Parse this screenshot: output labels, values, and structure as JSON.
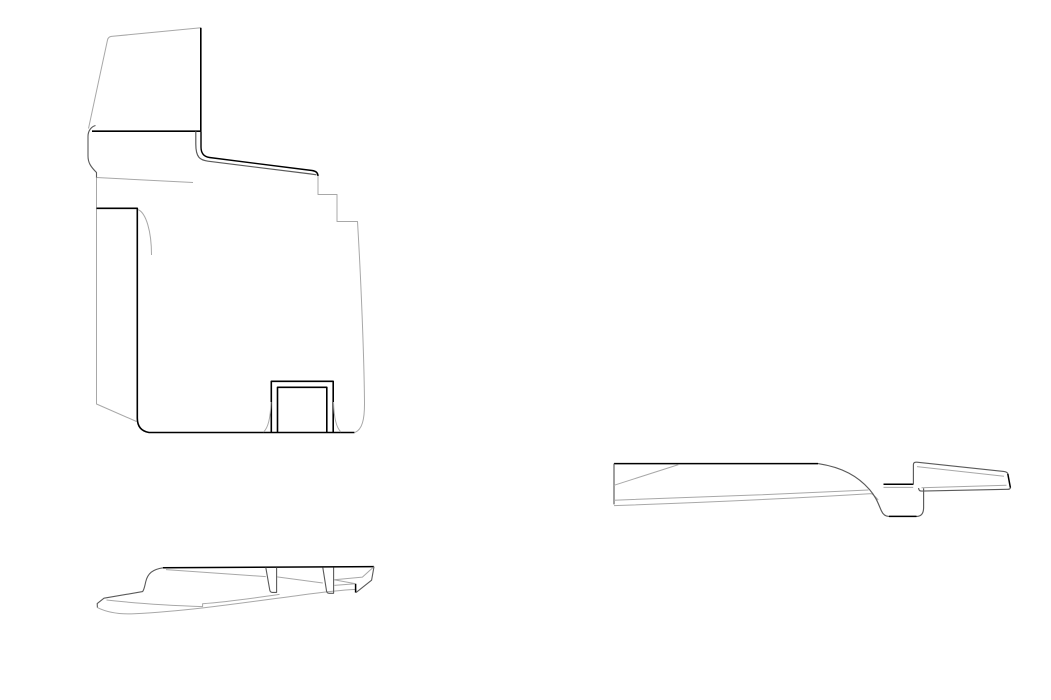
{
  "canvas": {
    "width": 1051,
    "height": 700,
    "background": "#ffffff"
  },
  "palette": {
    "bold": "#000000",
    "dark": "#5a5a5a",
    "light": "#a8a8a8"
  },
  "drawings": [
    {
      "id": "panel-side-view",
      "label": "large panel section with window flange and U-channel cutout",
      "paths": [
        {
          "c": "light",
          "w": 1,
          "d": "M88.5,128.5 C92,112 101,70 107.5,40 Q108.2,36.8 111.5,36.4 L201,27.8"
        },
        {
          "c": "bold",
          "w": 1.6,
          "d": "M200.8,27.8 L200.8,131.2"
        },
        {
          "c": "bold",
          "w": 1.6,
          "d": "M92,131.2 L201,131.2"
        },
        {
          "c": "dark",
          "w": 1.1,
          "d": "M95.5,125.5 C91.5,126.5 88,130.5 88,136.5 L88,156 C88,162.5 90.5,166.5 96.5,172.5 L96.5,178"
        },
        {
          "c": "light",
          "w": 1,
          "d": "M96.5,177.5 L193,182.5"
        },
        {
          "c": "light",
          "w": 1,
          "d": "M96.5,178 L96.5,404 L136.5,421.5"
        },
        {
          "c": "bold",
          "w": 1.6,
          "d": "M96.5,208.3 L137.3,208.3 L137.3,418 Q137.3,430.5 149,432.5 L354.5,432.5"
        },
        {
          "c": "light",
          "w": 1,
          "d": "M138,209.5 C146,213 151.5,231 151.5,255"
        },
        {
          "c": "bold",
          "w": 1.4,
          "d": "M201,131.2 L201,147 Q201,156.3 209.5,157.5 L312,170.5 Q318,171.3 318,176"
        },
        {
          "c": "dark",
          "w": 1.2,
          "d": "M195.8,131.2 L195.8,144 C195.8,157.5 200,160.1 208,161.2 L310,173.9 L316.5,174.8"
        },
        {
          "c": "light",
          "w": 1,
          "d": "M318,176 L318,194.5 L337,194.5 L337,221.5 L357.5,221.5 C361,280 364,355 364.5,402 C364.7,420 362,429.5 355,432.4"
        },
        {
          "c": "bold",
          "w": 1.6,
          "d": "M271.3,432.5 L271.3,381.3 L333.2,381.3 L333.2,432.5"
        },
        {
          "c": "bold",
          "w": 1.6,
          "d": "M277.5,432.5 L277.5,387.3 L326.8,387.3 L326.8,432.5"
        },
        {
          "c": "light",
          "w": 1,
          "d": "M271,402 C270.5,419 267.5,428.5 263.5,432"
        },
        {
          "c": "light",
          "w": 1,
          "d": "M333.5,402 C334,419 337,428.5 341,432"
        }
      ]
    },
    {
      "id": "sill-strip-profile",
      "label": "thin sill strip profile with two tabs",
      "paths": [
        {
          "c": "bold",
          "w": 1.5,
          "d": "M163,567.8 L374,566.6"
        },
        {
          "c": "dark",
          "w": 1.1,
          "d": "M163,567.8 C152.5,569.3 147.8,573.5 145.8,581.5 C144.8,585.5 144.3,589.3 142.6,591.6 L104,598.2 L97.2,603.6 L97.4,607.6"
        },
        {
          "c": "light",
          "w": 1,
          "d": "M97.4,607.6 C109,613.4 121,614.4 134,613.8 C190,611 245,602.5 300,595.2 C325,591.9 343,590 356,589.4 L356,592.6"
        },
        {
          "c": "light",
          "w": 1,
          "d": "M106.5,600 C138,603.6 168,605.4 202.6,606.6 L202.6,603.7 C227,602 253,598.3 279.5,594.4"
        },
        {
          "c": "dark",
          "w": 1.1,
          "d": "M265.8,567.5 L269.8,590.3 Q270.3,592.4 272.3,592.4 L276.6,592.4 L276.6,567.5"
        },
        {
          "c": "dark",
          "w": 1.1,
          "d": "M322.8,567.5 L326.6,591.3 Q327.1,593.3 329.1,593.3 L333.6,593.3 L333.6,567.5"
        },
        {
          "c": "light",
          "w": 1,
          "d": "M166,569.6 L265.8,576.6"
        },
        {
          "c": "light",
          "w": 1,
          "d": "M277,576.9 L322.8,583"
        },
        {
          "c": "light",
          "w": 1,
          "d": "M334,579.8 L355,583.6"
        },
        {
          "c": "light",
          "w": 1,
          "d": "M374,566.6 L362.4,577.1 L334.3,579.8"
        },
        {
          "c": "light",
          "w": 1,
          "d": "M334.3,585.4 L355.6,583.8"
        },
        {
          "c": "bold",
          "w": 1.5,
          "d": "M355.6,583.8 L355.6,592.6"
        },
        {
          "c": "dark",
          "w": 1.1,
          "d": "M356,592.6 L371.6,580.2 L374,566.6"
        }
      ]
    },
    {
      "id": "rocker-step-section",
      "label": "rocker cross-section with step recess and slanted flange",
      "paths": [
        {
          "c": "bold",
          "w": 1.5,
          "d": "M614,463.6 L818,463.6"
        },
        {
          "c": "dark",
          "w": 1.15,
          "d": "M614,463.6 L614,504.4"
        },
        {
          "c": "light",
          "w": 1,
          "d": "M614,485.3 L678.5,464.6"
        },
        {
          "c": "light",
          "w": 1,
          "d": "M614,500.2 C688,497.8 788,494 868.5,490"
        },
        {
          "c": "light",
          "w": 1,
          "d": "M614,505.6 C690,503 790,498.6 871.5,493.6 C874.5,495.8 876.5,497.6 878.2,500"
        },
        {
          "c": "dark",
          "w": 1.15,
          "d": "M818,463.6 C843,467.5 858,476.5 869.5,489.5 C876.5,497.5 878.5,504.5 881.3,510.6 Q883.8,516.4 889,516.4"
        },
        {
          "c": "bold",
          "w": 1.5,
          "d": "M889,516.4 L916.5,516.4"
        },
        {
          "c": "dark",
          "w": 1.15,
          "d": "M916.5,516.4 Q923.6,516.4 923.6,507.5 L923.6,488.2"
        },
        {
          "c": "bold",
          "w": 1.5,
          "d": "M883.5,484.3 L913.2,484.3"
        },
        {
          "c": "light",
          "w": 1,
          "d": "M883.5,487.4 L913.2,487.4"
        },
        {
          "c": "dark",
          "w": 1.15,
          "d": "M913.4,484.6 L913.4,464.6 Q913.4,461.9 916.9,462.2 L1003.5,471.4 Q1007.5,471.9 1007.8,473.8 M1010.4,487.6 Q1010.6,489.4 1006.8,489.3 L921.8,491.1 Q918.6,491.1 918.6,488.0"
        },
        {
          "c": "bold",
          "w": 1.5,
          "d": "M1007.8,473.8 L1010.4,487.6"
        },
        {
          "c": "light",
          "w": 1,
          "d": "M917,466.6 L1004,476.2"
        },
        {
          "c": "light",
          "w": 1,
          "d": "M921.5,487.7 L1006.5,485.3"
        }
      ]
    }
  ]
}
